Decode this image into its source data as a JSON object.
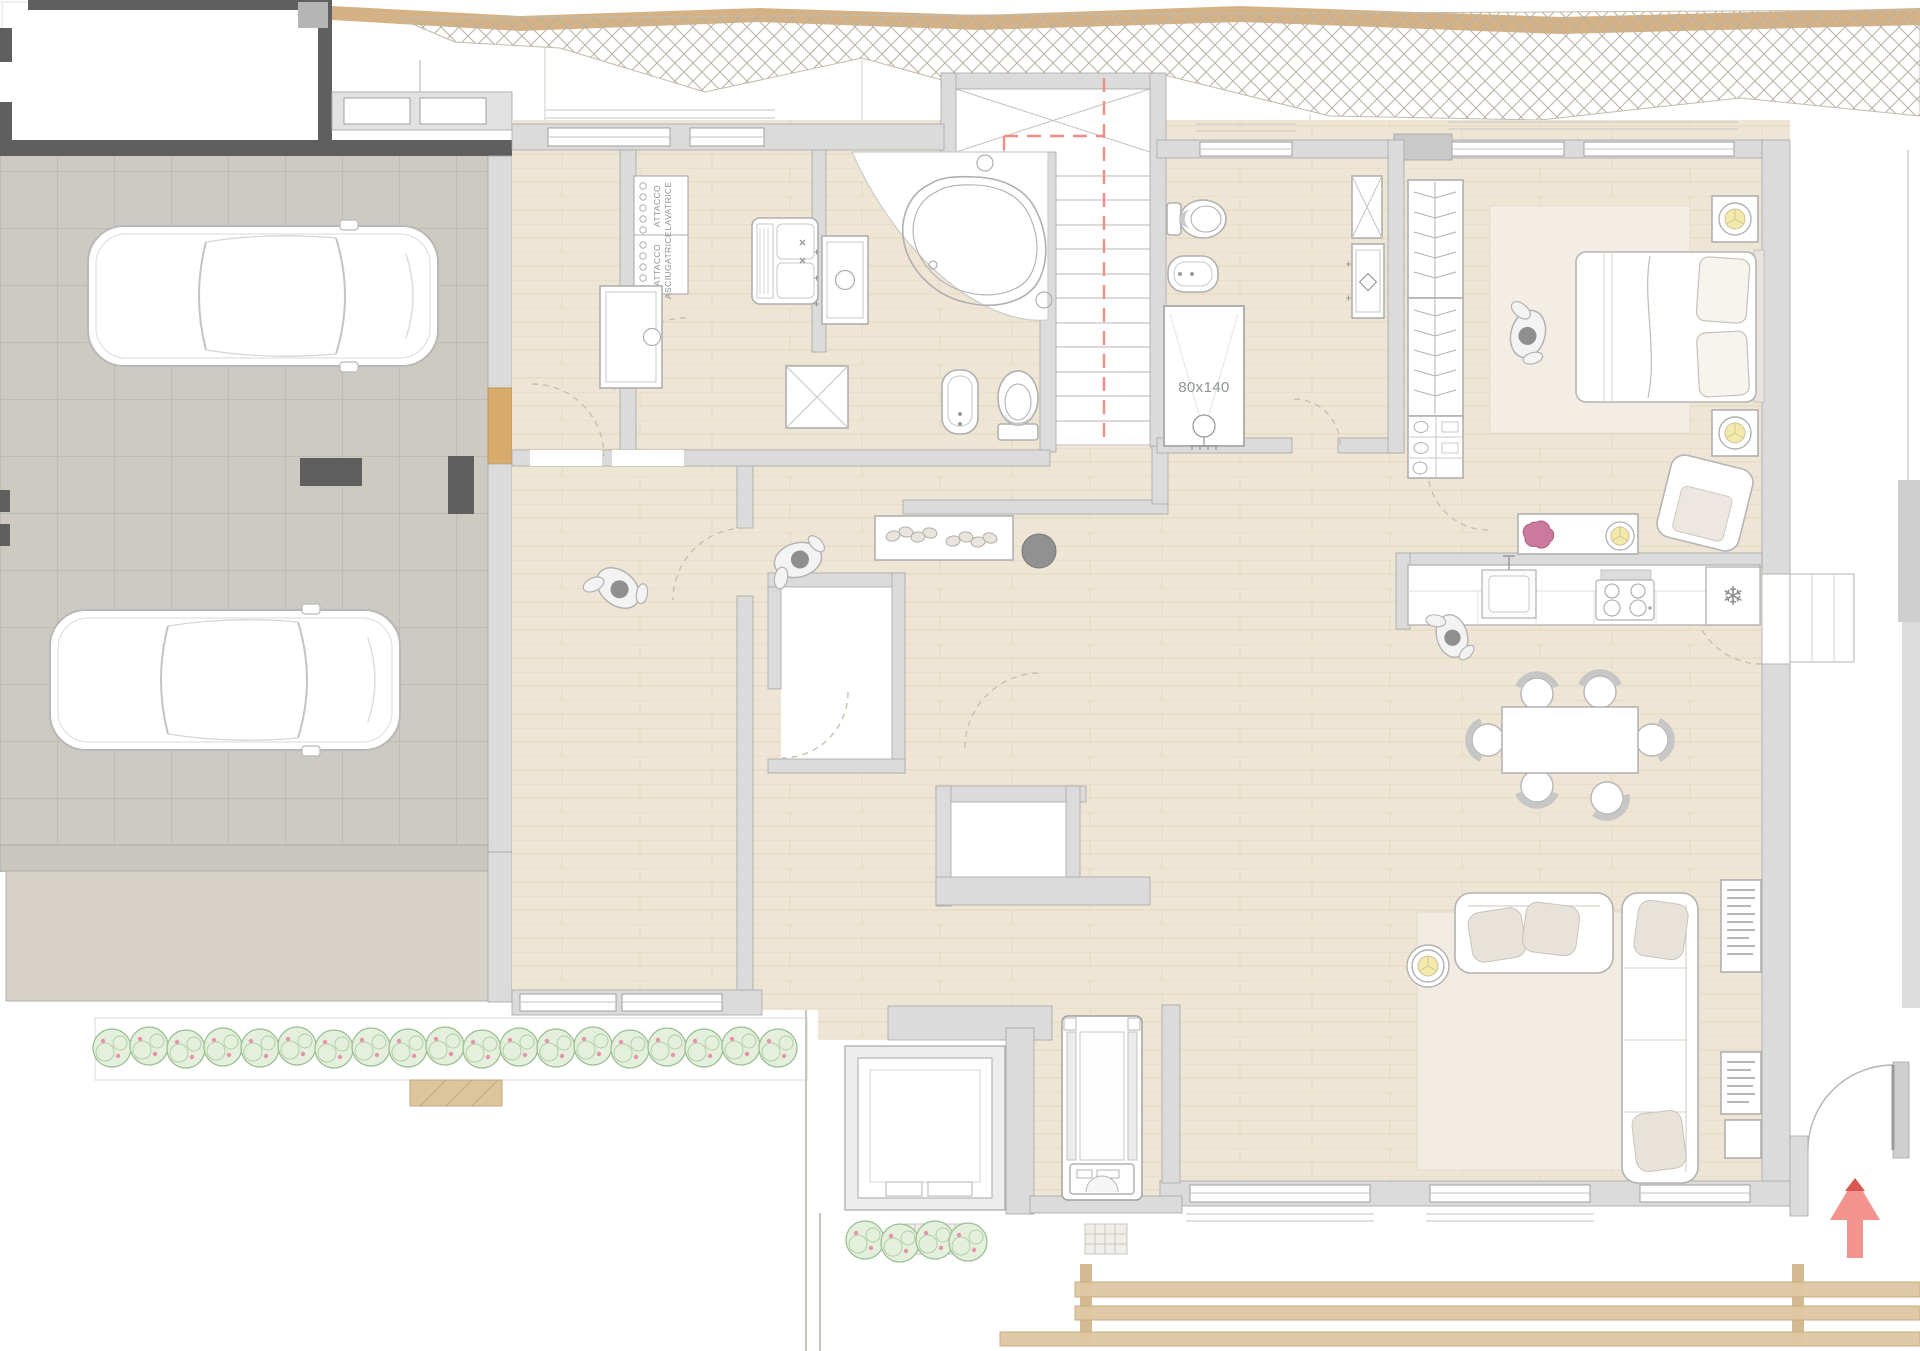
{
  "plan": {
    "labels": {
      "attacco": "ATTACCO",
      "lavatrice": "LAVATRICE",
      "asciugatrice": "ASCIUGATRICE",
      "shower_size": "80x140"
    },
    "symbols": {
      "fridge_snowflake": "❄"
    },
    "colors": {
      "wood_floor": "#eee5d4",
      "plank_line": "#e0d4bd",
      "garage_tile": "#cdc9c3",
      "tile_line": "#b9b4ad",
      "wall_light": "#dbdbdb",
      "wall_dark": "#5f5f5f",
      "fixture_stroke": "#b0b0b0",
      "rug": "#f1ebe1",
      "section_red": "#ef8d86",
      "arrow_salmon": "#f2948d",
      "arrow_tip": "#d95752",
      "lamp_yellow": "#f3e9aa",
      "flower_pink": "#cb7a9b",
      "plant_green": "#7db58f",
      "hedge_green": "#9bbf92",
      "terrain_tan": "#d4b286",
      "deck_wood": "#ddc6a1",
      "threshold_wood": "#d8ab6b"
    },
    "fixtures": [
      "corner-bathtub",
      "toilet",
      "bidet",
      "shower-tray",
      "vanity-sink",
      "utility-sink",
      "washer-dryer-connection-panel",
      "staircase",
      "wardrobe",
      "double-bed",
      "nightstand-lamp",
      "armchair",
      "console-table",
      "kitchen-counter",
      "kitchen-sink",
      "cooktop",
      "refrigerator",
      "dining-table",
      "dining-chair",
      "sofa",
      "round-side-table",
      "bookshelf",
      "pouf",
      "shoe-sideboard",
      "treadmill",
      "exercise-machine",
      "car",
      "hedge-bush",
      "wood-deck",
      "entry-arrow",
      "person",
      "plant"
    ]
  }
}
